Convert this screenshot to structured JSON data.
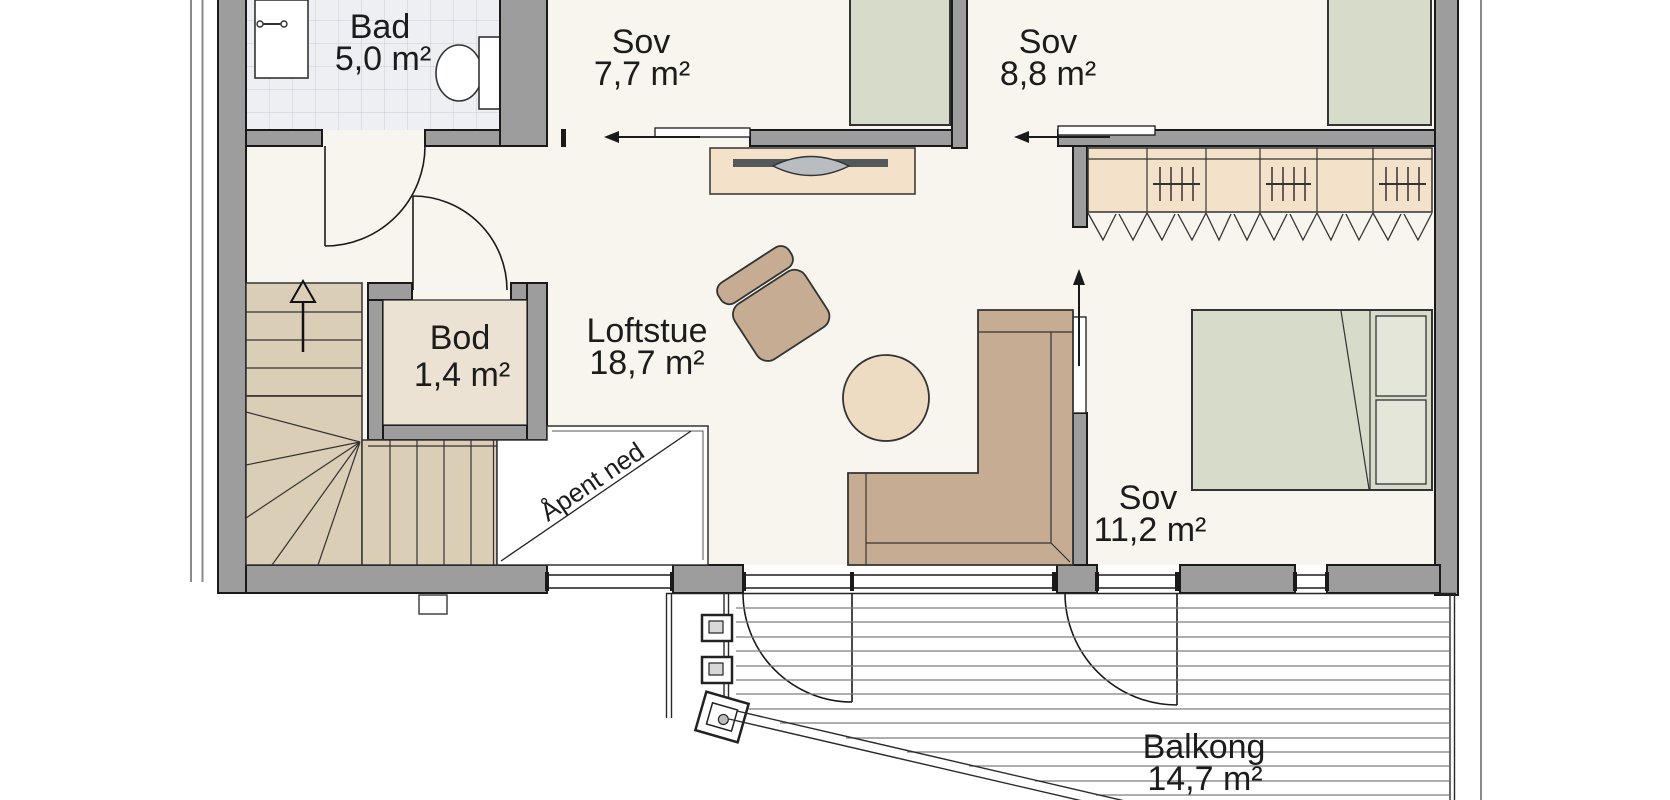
{
  "rooms": {
    "bad": {
      "name": "Bad",
      "area": "5,0 m²"
    },
    "sov1": {
      "name": "Sov",
      "area": "7,7 m²"
    },
    "sov2": {
      "name": "Sov",
      "area": "8,8 m²"
    },
    "bod": {
      "name": "Bod",
      "area": "1,4 m²"
    },
    "loftstue": {
      "name": "Loftstue",
      "area": "18,7 m²"
    },
    "sov3": {
      "name": "Sov",
      "area": "11,2 m²"
    },
    "balkong": {
      "name": "Balkong",
      "area": "14,7 m²"
    }
  },
  "annotations": {
    "open_below": "Åpent ned"
  },
  "icons": {
    "stairs_direction": "stairs-up-arrow",
    "sliding_doors": "slide-direction-arrow"
  },
  "colors": {
    "wall": "#9d9d9d",
    "ink": "#1a1a1a",
    "outline": "#333333",
    "floor": "#f8f5ef",
    "badfloor": "#edeff3",
    "tileline": "#c9cdd5",
    "bodfloor": "#ebe2d3",
    "stairs": "#dbceb7",
    "bed": "#d6dbca",
    "pillow": "#e3e6d9",
    "sofa": "#c5ac92",
    "pouf": "#eedcc2",
    "cabinet": "#f3e2c9",
    "tv": "#54585c",
    "text": "#1c1c1c"
  }
}
